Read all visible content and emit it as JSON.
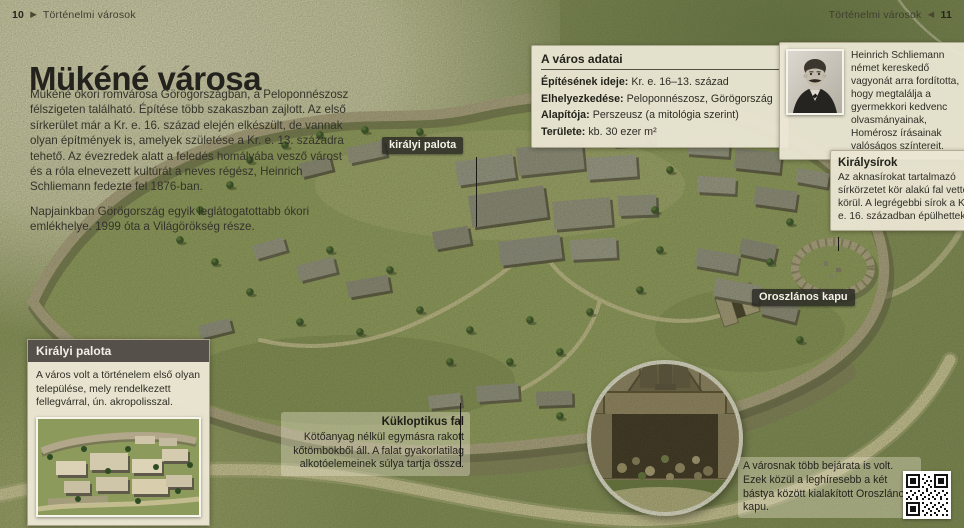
{
  "folio_left": {
    "num": "10",
    "title": "Történelmi városok"
  },
  "folio_right": {
    "num": "11",
    "title": "Történelmi városok"
  },
  "icons": {
    "arrow_right": "▶",
    "arrow_left": "◀"
  },
  "title": "Mükéné városa",
  "intro": {
    "p1": "Mükéné ókori romvárosa Görögországban, a Peloponnészosz félszigeten található. Építése több szakaszban zajlott. Az első sírkerület már a Kr. e. 16. század elején elkészült, de vannak olyan építmények is, amelyek születése a Kr. e. 13. századra tehető. Az évezredek alatt a feledés homályába vesző várost és a róla elnevezett kultúrát a neves régész, Heinrich Schliemann fedezte fel 1876-ban.",
    "p2": "Napjainkban Görögország egyik leglátogatottabb ókori emlékhelye. 1999 óta a Világörökség része."
  },
  "city_data": {
    "title": "A város adatai",
    "rows": [
      {
        "label": "Építésének ideje:",
        "value": "Kr. e. 16–13. század"
      },
      {
        "label": "Elhelyezkedése:",
        "value": "Peloponnészosz, Görögország"
      },
      {
        "label": "Alapítója:",
        "value": "Perszeusz (a mitológia szerint)"
      },
      {
        "label": "Területe:",
        "value": "kb. 30 ezer m²"
      }
    ]
  },
  "schliemann": {
    "text": "Heinrich Schliemann német kereskedő vagyonát arra fordította, hogy megtalálja a gyermekkori kedvenc olvasmányainak, Homérosz írásainak valóságos színtereit."
  },
  "royal_tombs": {
    "title": "Királysírok",
    "text": "Az aknasírokat tartalmazó sírkörzetet kör alakú fal vette körül. A legrégebbi sírok a Kr. e. 16. században épülhettek."
  },
  "labels": {
    "palace": "királyi palota",
    "lion_gate": "Oroszlános kapu"
  },
  "royal_palace_box": {
    "title": "Királyi palota",
    "text": "A város volt a történelem első olyan települése, mely rendelkezett fellegvárral, ún. akropolisszal."
  },
  "cyclopean_wall": {
    "title": "Kükloptikus fal",
    "text": "Kötőanyag nélkül egymásra rakott kőtömbökből áll. A falat gyakorlatilag alkotóelemeinek súlya tartja össze."
  },
  "entrances_note": "A városnak több bejárata is volt. Ezek közül a leghíresebb a két bástya között kialakított Oroszlános kapu.",
  "colors": {
    "parchment": "#eae6d3",
    "grass": "#8d9a5f",
    "stone_wall": "#b4a98b",
    "chip_bg": "#2a2924",
    "box_header": "#55504a"
  }
}
